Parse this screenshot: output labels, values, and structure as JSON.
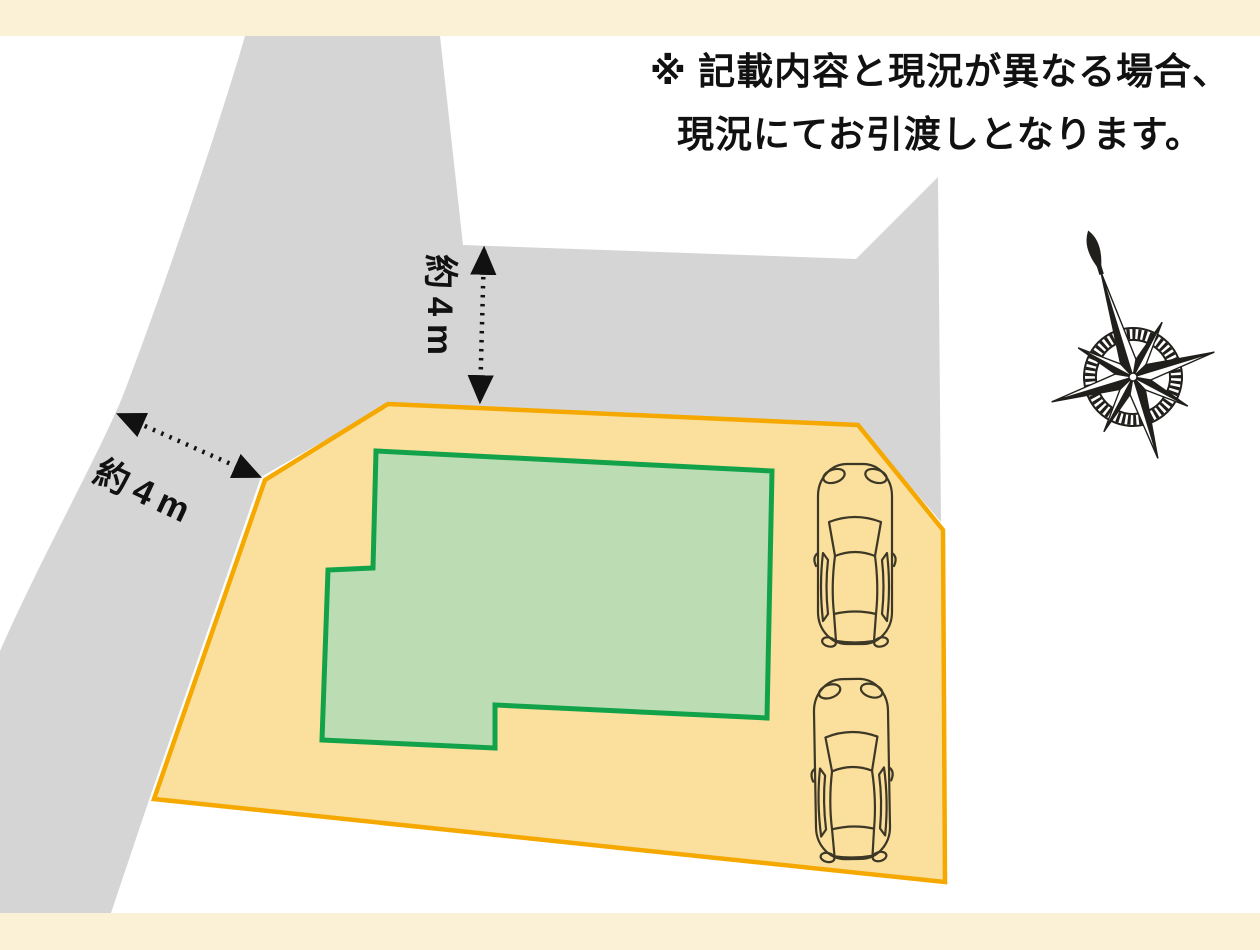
{
  "page": {
    "background": "#ffffff",
    "border_band_color": "#FBF1D6"
  },
  "disclaimer": {
    "line1": "※ 記載内容と現況が異なる場合、",
    "line2": "現況にてお引渡しとなります。"
  },
  "dimension_labels": {
    "north_road": "約4m",
    "west_road": "約4m"
  },
  "site_plan": {
    "plot": "land-plot",
    "building": "building-footprint",
    "parking_spaces": 2,
    "roads": [
      "west-road",
      "north-road"
    ],
    "compass": "compass-rose-pointing-north"
  },
  "colors": {
    "road": "#D5D5D5",
    "plot_fill": "#FBDF9D",
    "plot_stroke": "#F5A800",
    "building_fill": "#BCDDB4",
    "building_stroke": "#12A249",
    "car_outline": "#3D3826",
    "arrow": "#111111",
    "text": "#111111",
    "compass": "#211F1C"
  }
}
